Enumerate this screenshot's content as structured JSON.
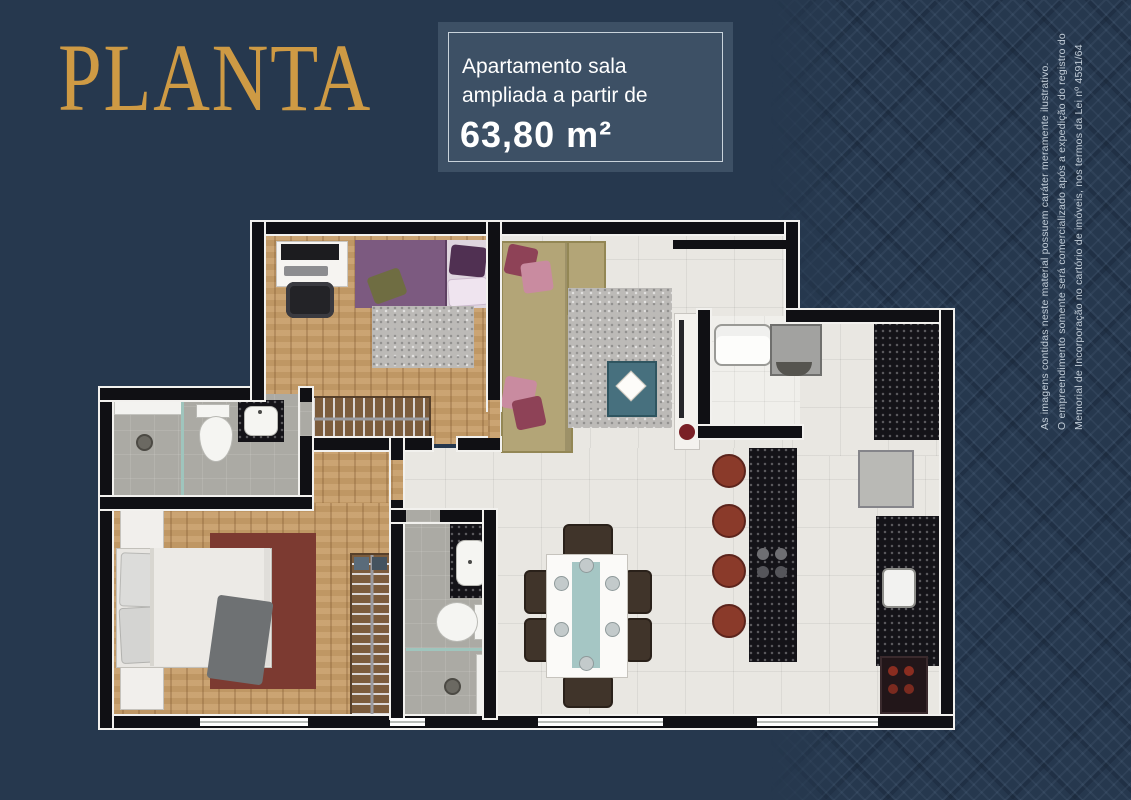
{
  "page": {
    "title_label": "PLANTA"
  },
  "info_box": {
    "line1": "Apartamento sala",
    "line2": "ampliada a partir de",
    "area_value": "63,80 m²"
  },
  "disclaimer": {
    "line1": "As imagens contidas neste material possuem caráter meramente ilustrativo.",
    "line2": "O empreendimento somente será comercializado após a expedição do registro do",
    "line3": "Memorial de Incorporação no cartório de imóveis, nos termos da Lei nº 4591/64"
  },
  "colors": {
    "background": "#26384E",
    "title_gold": "#CE9A44",
    "info_box_bg": "#3D5065",
    "info_box_border": "#C9D3DB",
    "text_light": "#FFFFFF",
    "disclaimer_text": "#C2CDD8",
    "wall_black": "#101014",
    "wood_floor": "#C79D68",
    "tile_floor": "#E9E7E2",
    "bath_floor": "#ABAAA4",
    "rug_red": "#7C3A31",
    "sofa_beige": "#B3A577",
    "bed_purple": "#7C5A80"
  },
  "floorplan": {
    "rooms": [
      "bedroom-2",
      "living-room",
      "service-area",
      "kitchen",
      "dining-area",
      "bathroom-1",
      "master-bedroom",
      "bathroom-2",
      "hall"
    ]
  }
}
